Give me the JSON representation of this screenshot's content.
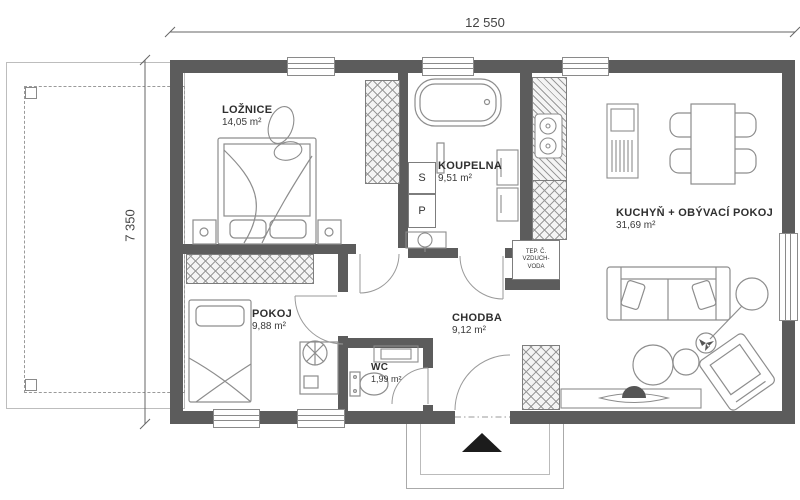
{
  "plan": {
    "type": "residential floor plan",
    "dims": {
      "width_label": "12 550",
      "height_label": "7 350"
    },
    "rooms": [
      {
        "id": "loznice",
        "name": "LOŽNICE",
        "area": "14,05 m²"
      },
      {
        "id": "koupelna",
        "name": "KOUPELNA",
        "area": "9,51 m²"
      },
      {
        "id": "pokoj",
        "name": "POKOJ",
        "area": "9,88 m²"
      },
      {
        "id": "chodba",
        "name": "CHODBA",
        "area": "9,12 m²"
      },
      {
        "id": "wc",
        "name": "WC",
        "area": "1,99 m²"
      },
      {
        "id": "kuchyn",
        "name": "KUCHYŇ + OBÝVACÍ POKOJ",
        "area": "31,69 m²"
      }
    ],
    "appliances": {
      "s_label": "S",
      "p_label": "P"
    },
    "tech_unit": {
      "line1": "TEP. Č.",
      "line2": "VZDUCH-",
      "line3": "VODA"
    },
    "colors": {
      "wall": "#5c5c5c",
      "furniture_line": "#8d8d8d",
      "text": "#333333"
    }
  }
}
